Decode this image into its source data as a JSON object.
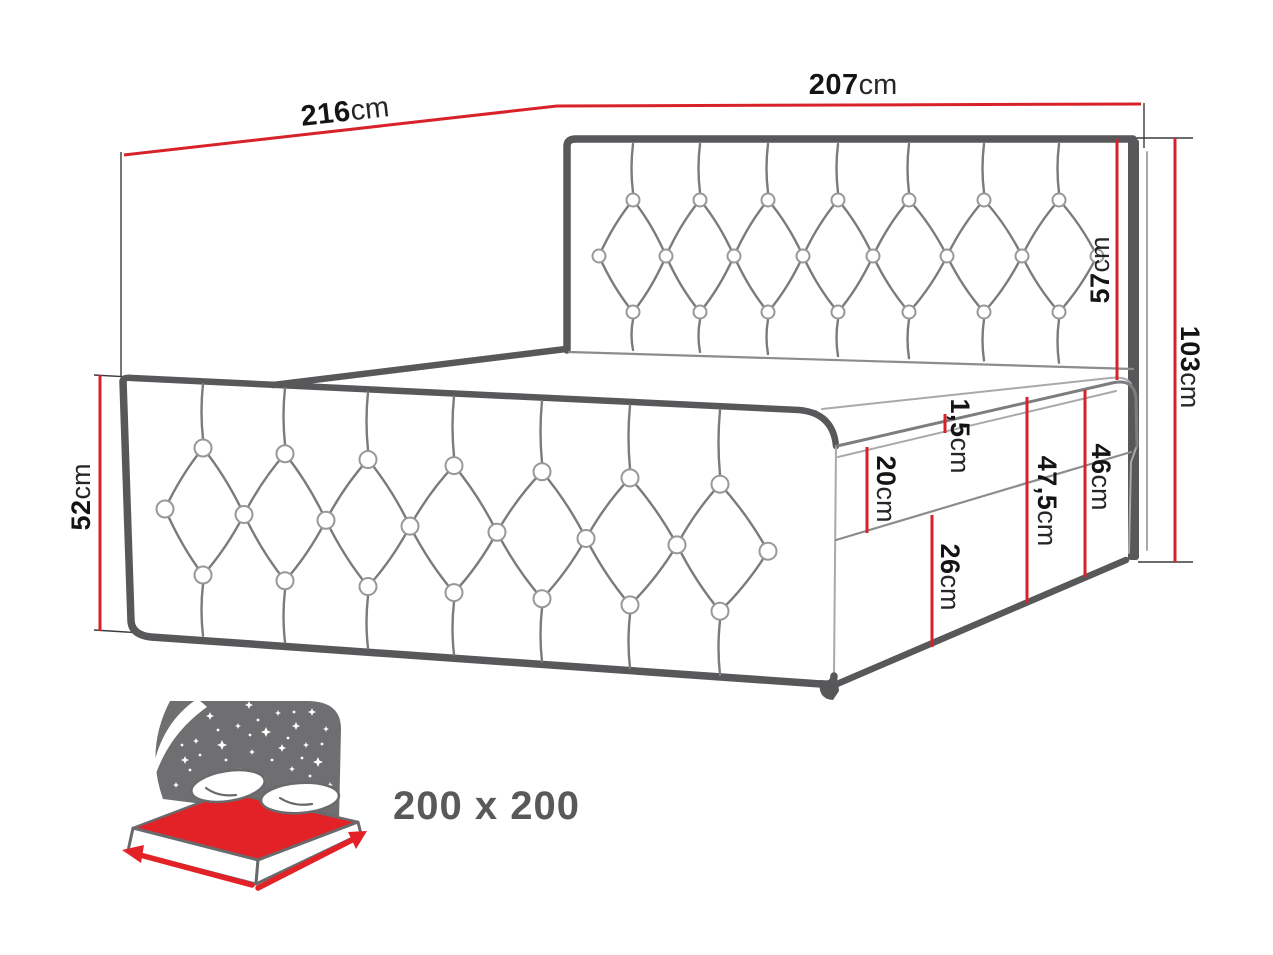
{
  "page": {
    "background": "#ffffff"
  },
  "colors": {
    "dimension_red": "#d8222a",
    "line_dark": "#58585a",
    "line_mid": "#7d7d80",
    "line_light": "#a9a9ab",
    "text_black": "#141414",
    "icon_gray": "#6f6f71",
    "icon_red": "#e32227",
    "size_gray": "#59595b"
  },
  "dimensions": {
    "length": {
      "value": "216",
      "unit": "cm"
    },
    "width": {
      "value": "207",
      "unit": "cm"
    },
    "headboard_height": {
      "value": "103",
      "unit": "cm"
    },
    "headboard_above_mattress": {
      "value": "57",
      "unit": "cm"
    },
    "side_panel_height": {
      "value": "52",
      "unit": "cm"
    },
    "topper_thickness": {
      "value": "1,5",
      "unit": "cm"
    },
    "mattress_height": {
      "value": "20",
      "unit": "cm"
    },
    "base_height": {
      "value": "26",
      "unit": "cm"
    },
    "total_side_height": {
      "value": "47,5",
      "unit": "cm"
    },
    "mattress_plus_base_height": {
      "value": "46",
      "unit": "cm"
    }
  },
  "size_badge": {
    "label": "200 x 200"
  }
}
